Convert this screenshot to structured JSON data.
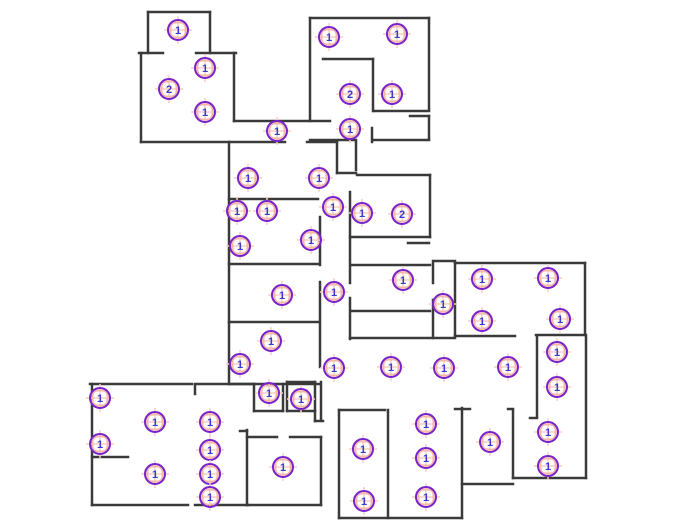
{
  "canvas": {
    "width": 676,
    "height": 530,
    "background": "#ffffff"
  },
  "style": {
    "wall_color": "#3a3a3a",
    "wall_thickness": 2.5,
    "marker_ring_color": "#7722cc",
    "marker_number_color": "#3a3acc",
    "marker_accent_color": "#f2b8aa",
    "marker_accent_light": "#f8cfc4",
    "marker_radius": 10
  },
  "walls": [
    [
      148,
      12,
      210,
      12
    ],
    [
      148,
      12,
      148,
      53
    ],
    [
      210,
      12,
      210,
      53
    ],
    [
      139,
      53,
      163,
      53
    ],
    [
      196,
      53,
      236,
      53
    ],
    [
      141,
      53,
      141,
      142
    ],
    [
      141,
      142,
      285,
      142
    ],
    [
      307,
      142,
      337,
      142
    ],
    [
      234,
      53,
      234,
      121
    ],
    [
      234,
      121,
      330,
      121
    ],
    [
      372,
      128,
      372,
      142
    ],
    [
      374,
      140,
      429,
      140
    ],
    [
      310,
      140,
      356,
      140
    ],
    [
      310,
      18,
      429,
      18
    ],
    [
      310,
      18,
      310,
      121
    ],
    [
      429,
      18,
      429,
      110
    ],
    [
      374,
      111,
      429,
      111
    ],
    [
      323,
      59,
      373,
      59
    ],
    [
      373,
      59,
      373,
      111
    ],
    [
      410,
      116,
      429,
      116
    ],
    [
      429,
      116,
      429,
      139
    ],
    [
      337,
      142,
      337,
      173
    ],
    [
      356,
      142,
      356,
      170
    ],
    [
      337,
      173,
      356,
      173
    ],
    [
      229,
      142,
      229,
      384
    ],
    [
      229,
      199,
      318,
      199
    ],
    [
      229,
      264,
      318,
      264
    ],
    [
      229,
      322,
      318,
      322
    ],
    [
      229,
      384,
      320,
      384
    ],
    [
      320,
      217,
      320,
      265
    ],
    [
      320,
      282,
      320,
      367
    ],
    [
      357,
      175,
      430,
      175
    ],
    [
      350,
      192,
      350,
      283
    ],
    [
      430,
      175,
      430,
      237
    ],
    [
      350,
      237,
      430,
      237
    ],
    [
      408,
      243,
      429,
      243
    ],
    [
      352,
      265,
      430,
      265
    ],
    [
      350,
      298,
      350,
      339
    ],
    [
      352,
      311,
      430,
      311
    ],
    [
      433,
      261,
      433,
      283
    ],
    [
      433,
      300,
      433,
      338
    ],
    [
      435,
      261,
      455,
      261
    ],
    [
      350,
      338,
      455,
      338
    ],
    [
      455,
      336,
      515,
      336
    ],
    [
      536,
      335,
      585,
      335
    ],
    [
      455,
      263,
      585,
      263
    ],
    [
      455,
      263,
      455,
      336
    ],
    [
      585,
      263,
      585,
      335
    ],
    [
      537,
      336,
      537,
      417
    ],
    [
      530,
      418,
      537,
      418
    ],
    [
      586,
      335,
      586,
      478
    ],
    [
      513,
      478,
      586,
      478
    ],
    [
      513,
      410,
      513,
      478
    ],
    [
      508,
      409,
      513,
      409
    ],
    [
      455,
      409,
      470,
      409
    ],
    [
      462,
      408,
      462,
      518
    ],
    [
      462,
      484,
      513,
      484
    ],
    [
      339,
      410,
      385,
      410
    ],
    [
      339,
      410,
      339,
      518
    ],
    [
      388,
      410,
      388,
      518
    ],
    [
      339,
      518,
      462,
      518
    ],
    [
      321,
      382,
      321,
      420
    ],
    [
      321,
      437,
      321,
      505
    ],
    [
      90,
      384,
      192,
      384
    ],
    [
      195,
      384,
      195,
      394
    ],
    [
      197,
      384,
      254,
      384
    ],
    [
      92,
      384,
      92,
      505
    ],
    [
      92,
      457,
      128,
      457
    ],
    [
      92,
      505,
      188,
      505
    ],
    [
      195,
      505,
      248,
      505
    ],
    [
      247,
      430,
      247,
      505
    ],
    [
      240,
      431,
      247,
      431
    ],
    [
      247,
      437,
      277,
      437
    ],
    [
      290,
      437,
      321,
      437
    ],
    [
      247,
      505,
      321,
      505
    ],
    [
      254,
      384,
      254,
      411
    ],
    [
      254,
      411,
      283,
      411
    ],
    [
      283,
      384,
      283,
      411
    ],
    [
      287,
      382,
      315,
      382
    ],
    [
      287,
      382,
      287,
      411
    ],
    [
      287,
      411,
      315,
      411
    ],
    [
      315,
      382,
      315,
      421
    ],
    [
      315,
      421,
      323,
      421
    ]
  ],
  "markers": [
    {
      "x": 178,
      "y": 30,
      "count": "1"
    },
    {
      "x": 205,
      "y": 68,
      "count": "1"
    },
    {
      "x": 169,
      "y": 89,
      "count": "2"
    },
    {
      "x": 205,
      "y": 112,
      "count": "1"
    },
    {
      "x": 277,
      "y": 131,
      "count": "1"
    },
    {
      "x": 329,
      "y": 37,
      "count": "1"
    },
    {
      "x": 397,
      "y": 34,
      "count": "1"
    },
    {
      "x": 350,
      "y": 94,
      "count": "2"
    },
    {
      "x": 392,
      "y": 94,
      "count": "1"
    },
    {
      "x": 350,
      "y": 129,
      "count": "1"
    },
    {
      "x": 248,
      "y": 178,
      "count": "1"
    },
    {
      "x": 319,
      "y": 178,
      "count": "1"
    },
    {
      "x": 237,
      "y": 211,
      "count": "1"
    },
    {
      "x": 267,
      "y": 211,
      "count": "1"
    },
    {
      "x": 333,
      "y": 207,
      "count": "1"
    },
    {
      "x": 362,
      "y": 213,
      "count": "1"
    },
    {
      "x": 402,
      "y": 214,
      "count": "2"
    },
    {
      "x": 240,
      "y": 246,
      "count": "1"
    },
    {
      "x": 311,
      "y": 240,
      "count": "1"
    },
    {
      "x": 282,
      "y": 295,
      "count": "1"
    },
    {
      "x": 334,
      "y": 292,
      "count": "1"
    },
    {
      "x": 403,
      "y": 280,
      "count": "1"
    },
    {
      "x": 271,
      "y": 341,
      "count": "1"
    },
    {
      "x": 240,
      "y": 364,
      "count": "1"
    },
    {
      "x": 443,
      "y": 304,
      "count": "1"
    },
    {
      "x": 482,
      "y": 279,
      "count": "1"
    },
    {
      "x": 548,
      "y": 278,
      "count": "1"
    },
    {
      "x": 482,
      "y": 321,
      "count": "1"
    },
    {
      "x": 560,
      "y": 319,
      "count": "1"
    },
    {
      "x": 334,
      "y": 368,
      "count": "1"
    },
    {
      "x": 391,
      "y": 367,
      "count": "1"
    },
    {
      "x": 444,
      "y": 368,
      "count": "1"
    },
    {
      "x": 508,
      "y": 367,
      "count": "1"
    },
    {
      "x": 557,
      "y": 352,
      "count": "1"
    },
    {
      "x": 557,
      "y": 387,
      "count": "1"
    },
    {
      "x": 100,
      "y": 398,
      "count": "1"
    },
    {
      "x": 155,
      "y": 422,
      "count": "1"
    },
    {
      "x": 210,
      "y": 422,
      "count": "1"
    },
    {
      "x": 100,
      "y": 444,
      "count": "1"
    },
    {
      "x": 210,
      "y": 450,
      "count": "1"
    },
    {
      "x": 155,
      "y": 474,
      "count": "1"
    },
    {
      "x": 210,
      "y": 474,
      "count": "1"
    },
    {
      "x": 210,
      "y": 497,
      "count": "1"
    },
    {
      "x": 269,
      "y": 393,
      "count": "1"
    },
    {
      "x": 301,
      "y": 399,
      "count": "1"
    },
    {
      "x": 283,
      "y": 467,
      "count": "1"
    },
    {
      "x": 363,
      "y": 449,
      "count": "1"
    },
    {
      "x": 364,
      "y": 501,
      "count": "1"
    },
    {
      "x": 426,
      "y": 424,
      "count": "1"
    },
    {
      "x": 426,
      "y": 458,
      "count": "1"
    },
    {
      "x": 426,
      "y": 497,
      "count": "1"
    },
    {
      "x": 490,
      "y": 442,
      "count": "1"
    },
    {
      "x": 548,
      "y": 432,
      "count": "1"
    },
    {
      "x": 548,
      "y": 466,
      "count": "1"
    }
  ]
}
